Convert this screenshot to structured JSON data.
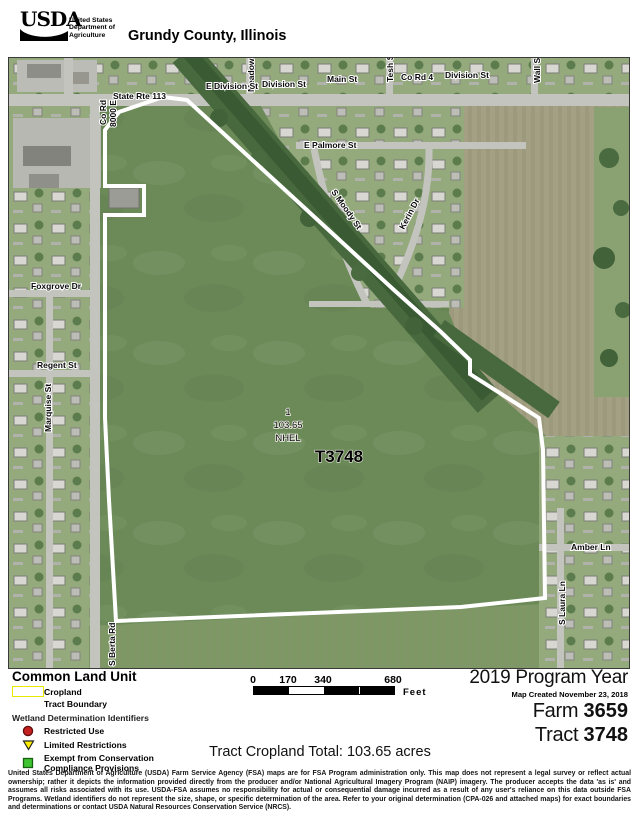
{
  "header": {
    "logo_text": "USDA",
    "agency_lines": [
      "United States",
      "Department of",
      "Agriculture"
    ],
    "title": "Grundy County, Illinois"
  },
  "map": {
    "streets": {
      "state_rte_113": "State Rte 113",
      "meadow_ln": "Meadow Ln",
      "e_division_st": "E Division St",
      "division_st_west": "Division St",
      "main_st": "Main St",
      "tesh_st": "Tesh St",
      "co_rd_4": "Co Rd 4",
      "division_st_east": "Division St",
      "wall_st": "Wall St",
      "co_rd_line1": "Co Rd",
      "co_rd_line2": "8000 E",
      "e_palmore_st": "E Palmore St",
      "s_moody_st": "S Moody St",
      "kerin_dr": "Kerin Dr",
      "foxgrove_dr": "Foxgrove Dr",
      "regent_st": "Regent St",
      "marquise_st": "Marquise St",
      "amber_ln": "Amber Ln",
      "s_laura_ln": "S Laura Ln",
      "s_berta_rd": "S Berta Rd"
    },
    "field": {
      "number": "1",
      "acres": "103.65",
      "hel_code": "NHEL",
      "tract": "T3748"
    }
  },
  "legend": {
    "title": "Common Land Unit",
    "items": {
      "cropland": "Cropland",
      "tract_boundary": "Tract Boundary"
    },
    "wetland_title": "Wetland Determination Identifiers",
    "wetland_items": {
      "restricted": "Restricted Use",
      "limited": "Limited Restrictions",
      "exempt_line1": "Exempt from Conservation",
      "exempt_line2": "Compliance Provisions"
    }
  },
  "scalebar": {
    "ticks": [
      "0",
      "170",
      "340",
      "680"
    ],
    "unit": "Feet"
  },
  "program": {
    "year": "2019 Program Year",
    "created": "Map Created November 23, 2018",
    "farm_label": "Farm",
    "farm_number": "3659",
    "tract_label": "Tract",
    "tract_number": "3748"
  },
  "totals": {
    "tract_cropland": "Tract Cropland Total:  103.65 acres"
  },
  "disclaimer": "United States Department of Agriculture (USDA) Farm Service Agency (FSA) maps are for FSA Program administration only. This map does not represent a legal survey or reflect actual ownership; rather it depicts the information provided directly from the producer and/or National Agricultural Imagery Program (NAIP) imagery. The producer accepts the data 'as is' and assumes all risks associated with its use. USDA-FSA assumes no responsibility for actual or consequential damage incurred as a result of any user's reliance on this data outside FSA Programs. Wetland identifiers do not represent the size, shape, or specific determination of the area. Refer to your original determination (CPA-026 and attached maps) for exact boundaries and determinations or contact USDA Natural Resources Conservation Service (NRCS).",
  "colors": {
    "tract_boundary": "#ffffff",
    "cropland_outline": "#e8e800",
    "restricted_use": "#c42020",
    "limited_restrictions": "#ffee00",
    "exempt": "#3ec431"
  }
}
